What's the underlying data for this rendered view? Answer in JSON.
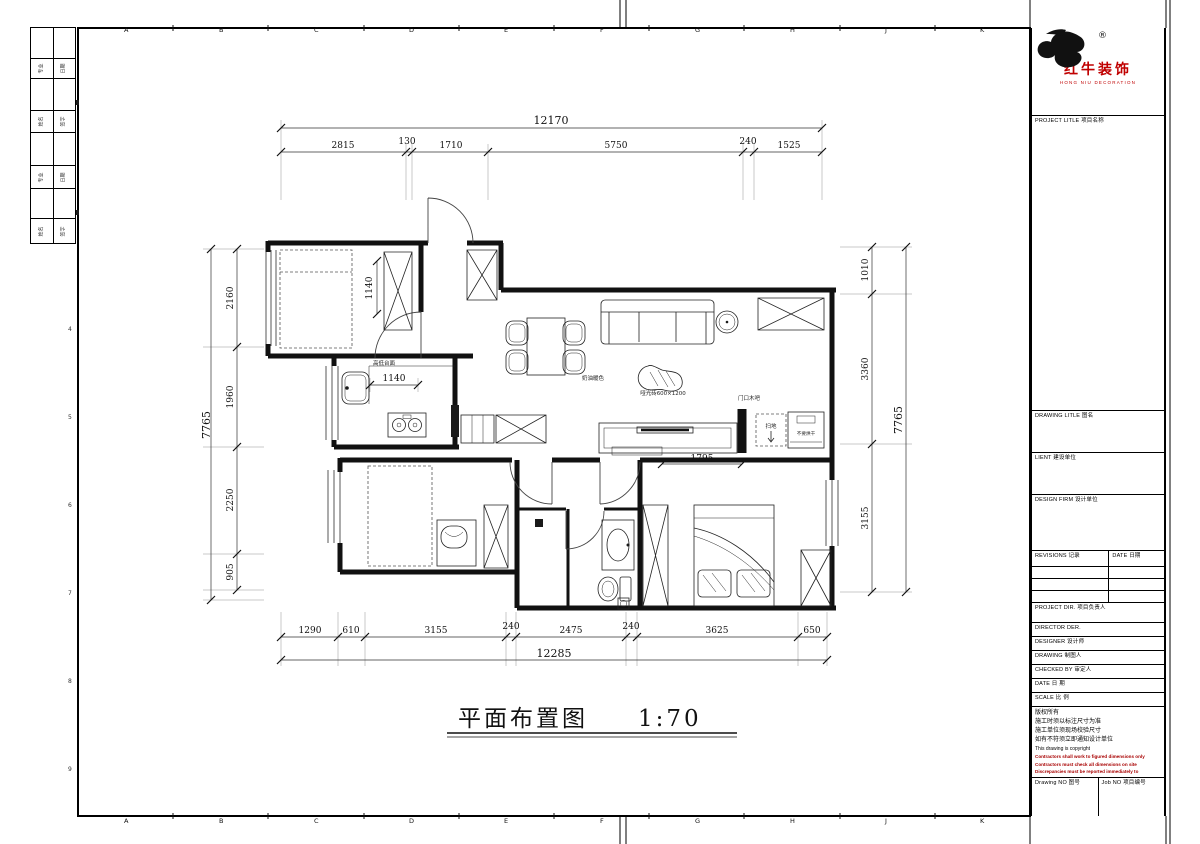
{
  "sheet": {
    "grid_letters": [
      "A",
      "B",
      "C",
      "D",
      "E",
      "F",
      "G",
      "H",
      "J",
      "K"
    ],
    "grid_numbers": [
      "1",
      "2",
      "3",
      "4",
      "5",
      "6",
      "7",
      "8",
      "9"
    ]
  },
  "side_strip": {
    "rows": [
      {
        "l": "专业",
        "r": "日期"
      },
      {
        "l": "姓名",
        "r": "签字"
      },
      {
        "l": "专业",
        "r": "日期"
      },
      {
        "l": "姓名",
        "r": "签字"
      }
    ]
  },
  "title_block": {
    "registered": "®",
    "brand_cn": "红牛装饰",
    "brand_en": "HONG NIU DECORATION",
    "brand_color": "#c00000",
    "warning_color": "#a80000",
    "project_title": "PROJECT LITLE  项目名称",
    "drawing_title": "DRAWING LITLE  图名",
    "client": "LIENT  建设单位",
    "design_firm": "DESIGN FIRM  设计单位",
    "revisions": "REVISIONS  记录",
    "rev_date": "DATE  日期",
    "project_dir": "PROJECT DIR.  项目负责人",
    "director": "DIRECTOR DER.",
    "designer": "DESIGNER   设计师",
    "drawing_by": "DRAWING    制图人",
    "checked_by": "CHECKED BY  审定人",
    "date": "DATE       日 期",
    "scale": "SCALE      比 例",
    "copyright_cn_1": "版权所有",
    "copyright_cn_2": "施工时须以标注尺寸为准",
    "copyright_cn_3": "施工单位须现场校验尺寸",
    "copyright_cn_4": "如有不符须立即通知设计单位",
    "copyright_en": "This drawing is copyright",
    "warning_1": "Contractors shall work to figured dimensions only",
    "warning_2": "Contractors must check all dimensions on site",
    "warning_3": "Discrepancies must be reported immediately to architects",
    "drawing_no": "Drawing NO  图号",
    "job_no": "Job NO  项目编号"
  },
  "plan": {
    "title": "平面布置图",
    "scale": "1:70",
    "labels": {
      "counter": "高低台面",
      "cream": "奶油暖色",
      "tile": "哑光砖600×1200",
      "door_bar": "门口木吧",
      "vacuum": "扫地",
      "dryer": "不要烘干"
    },
    "dims": {
      "top": {
        "overall": "12170",
        "segments": [
          "2815",
          "130",
          "1710",
          "5750",
          "240",
          "1525"
        ]
      },
      "bottom": {
        "overall": "12285",
        "segments": [
          "1290",
          "610",
          "3155",
          "240",
          "2475",
          "240",
          "3625",
          "650"
        ]
      },
      "left": {
        "overall": "7765",
        "segments": [
          "2160",
          "1960",
          "2250",
          "905"
        ]
      },
      "right": {
        "overall": "7765",
        "segments": [
          "1010",
          "3360",
          "3155"
        ]
      },
      "inner": {
        "wardrobe": "1140",
        "counter": "1140",
        "tv_wall": "1795"
      }
    }
  }
}
